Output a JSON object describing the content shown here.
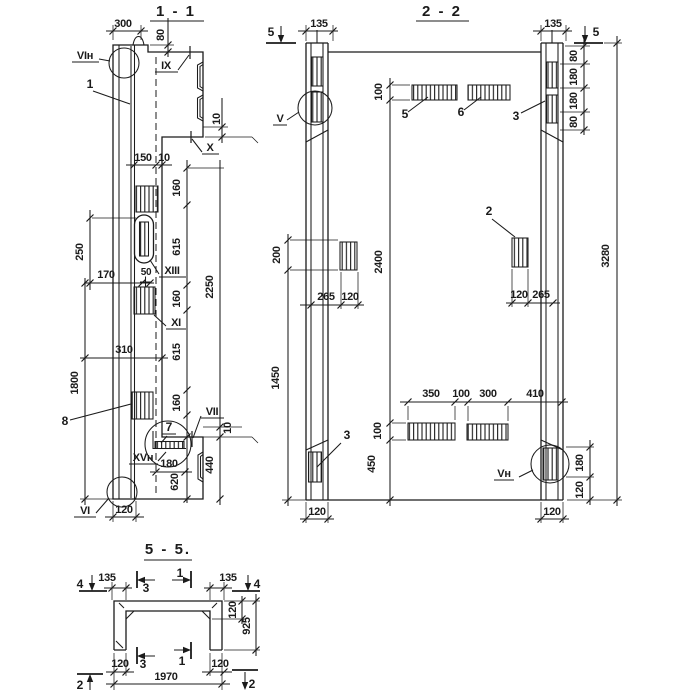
{
  "colors": {
    "ink": "#1b1b1b",
    "paper": "#ffffff"
  },
  "sections": {
    "s1": {
      "title": "1 - 1",
      "parts": {
        "p1": "1",
        "p7": "7",
        "p8": "8"
      },
      "callouts": {
        "vin": "VIн",
        "ix": "IX",
        "x": "X",
        "xiii": "XIII",
        "xi": "XI",
        "vii": "VII",
        "xvn": "XVн",
        "vi": "VI"
      },
      "dims": {
        "w300": "300",
        "h80": "80",
        "t10a": "10",
        "w150": "150",
        "w10": "10",
        "c160a": "160",
        "c615a": "615",
        "c160b": "160",
        "c615b": "615",
        "c160c": "160",
        "h2250": "2250",
        "h440": "440",
        "t10b": "10",
        "h620": "620",
        "w180": "180",
        "h250": "250",
        "w170": "170",
        "w50": "50",
        "w310": "310",
        "h1800": "1800",
        "w120": "120"
      }
    },
    "s2": {
      "title": "2 - 2",
      "parts": {
        "p2": "2",
        "p3a": "3",
        "p3b": "3",
        "p5": "5",
        "p6": "6"
      },
      "callouts": {
        "v": "V",
        "vn": "Vн"
      },
      "markers": {
        "m5l": "5",
        "m5r": "5"
      },
      "dims": {
        "w135l": "135",
        "w135r": "135",
        "c80a": "80",
        "c180a": "180",
        "c180b": "180",
        "c80b": "80",
        "h3280": "3280",
        "h100t": "100",
        "h2400": "2400",
        "h100b": "100",
        "h450": "450",
        "h200": "200",
        "h1450": "1450",
        "w265l": "265",
        "w120l": "120",
        "w120r": "120",
        "w265r": "265",
        "w350": "350",
        "w100": "100",
        "w300": "300",
        "w410": "410",
        "c180r": "180",
        "c120r": "120",
        "w120bl": "120",
        "w120br": "120"
      }
    },
    "s5": {
      "title": "5 - 5.",
      "markers": {
        "m4l": "4",
        "m4r": "4",
        "m3t": "3",
        "m1t": "1",
        "m3b": "3",
        "m1b": "1",
        "m2l": "2",
        "m2r": "2"
      },
      "dims": {
        "w135l": "135",
        "w135r": "135",
        "h120": "120",
        "h925": "925",
        "w120l": "120",
        "w120r": "120",
        "w1970": "1970"
      }
    }
  }
}
